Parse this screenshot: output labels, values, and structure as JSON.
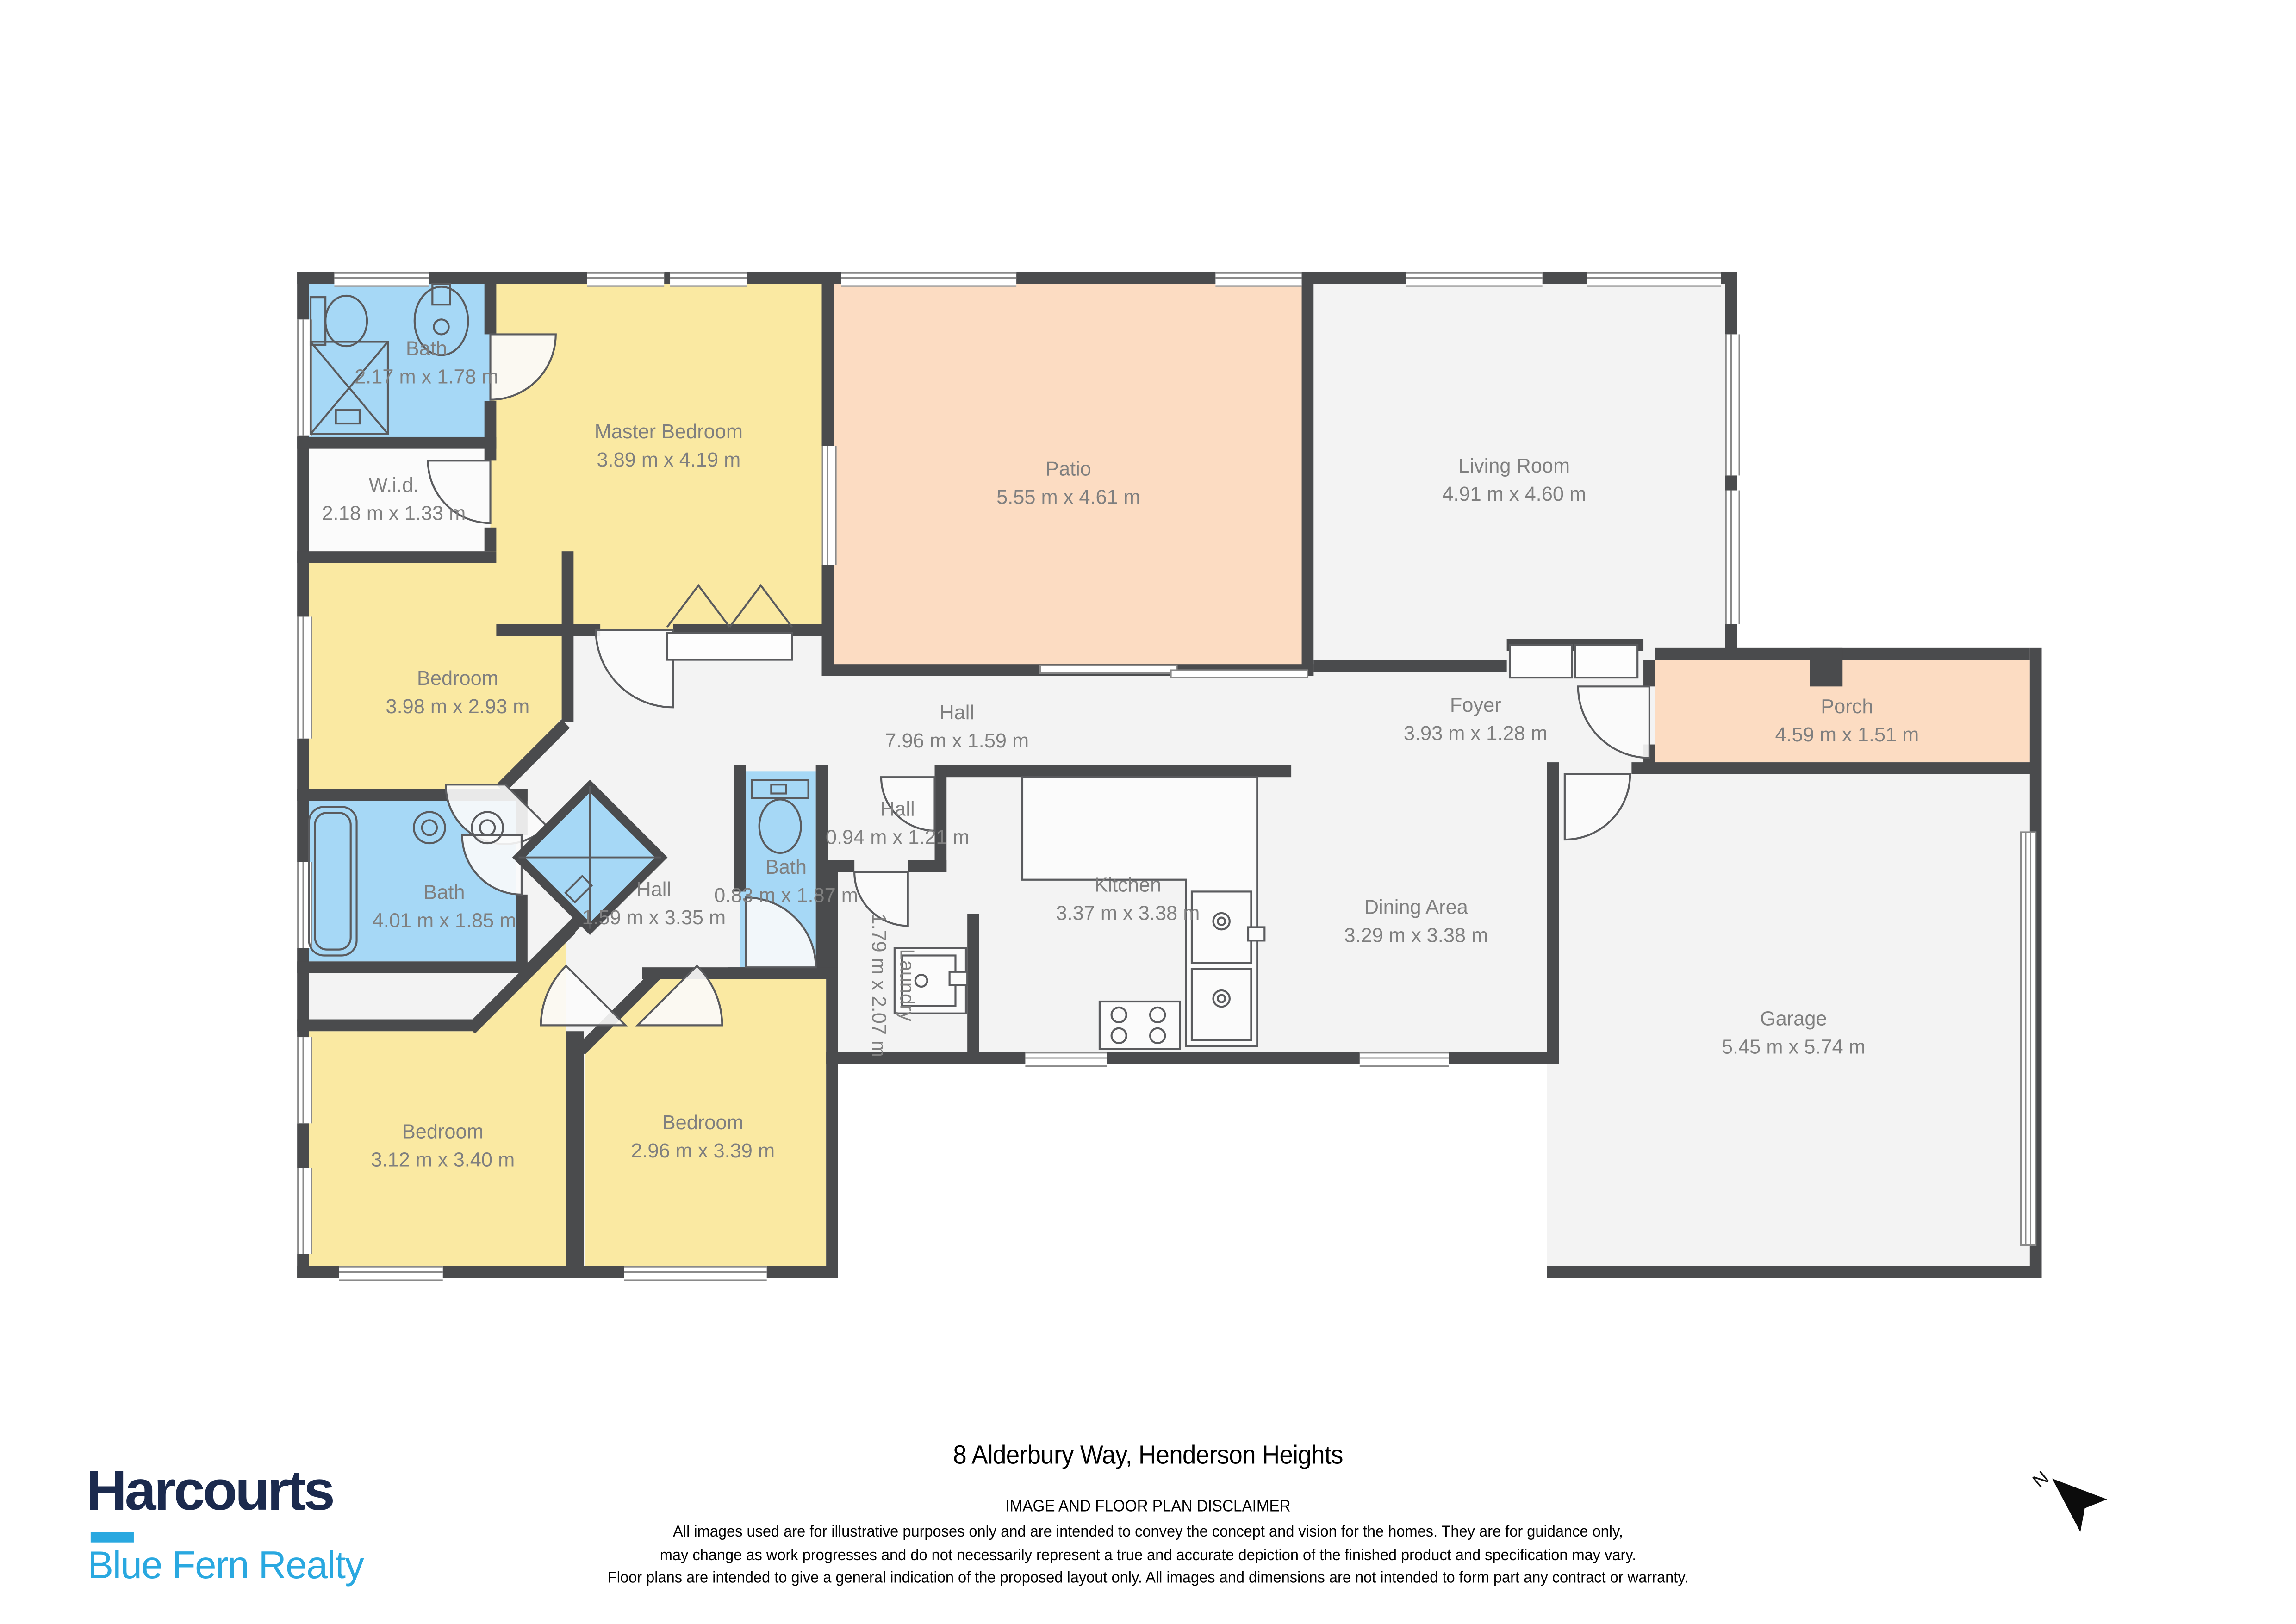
{
  "floorplan": {
    "rooms": [
      {
        "id": "bath-ensuite",
        "name": "Bath",
        "dims": "2.17 m x 1.78 m"
      },
      {
        "id": "wid",
        "name": "W.i.d.",
        "dims": "2.18 m x 1.33 m"
      },
      {
        "id": "master-bedroom",
        "name": "Master Bedroom",
        "dims": "3.89 m x 4.19 m"
      },
      {
        "id": "patio",
        "name": "Patio",
        "dims": "5.55 m x 4.61 m"
      },
      {
        "id": "living-room",
        "name": "Living Room",
        "dims": "4.91 m x 4.60 m"
      },
      {
        "id": "bedroom-mid-left",
        "name": "Bedroom",
        "dims": "3.98 m x 2.93 m"
      },
      {
        "id": "hall-main",
        "name": "Hall",
        "dims": "7.96 m x 1.59 m"
      },
      {
        "id": "foyer",
        "name": "Foyer",
        "dims": "3.93 m x 1.28 m"
      },
      {
        "id": "porch",
        "name": "Porch",
        "dims": "4.59 m x 1.51 m"
      },
      {
        "id": "bath-mid",
        "name": "Bath",
        "dims": "4.01 m x 1.85 m"
      },
      {
        "id": "hall-diagonal",
        "name": "Hall",
        "dims": "1.59 m x 3.35 m"
      },
      {
        "id": "bath-small",
        "name": "Bath",
        "dims": "0.83 m x 1.87 m"
      },
      {
        "id": "hall-small",
        "name": "Hall",
        "dims": "0.94 m x 1.21 m"
      },
      {
        "id": "laundry",
        "name": "Laundry",
        "dims": "1.79 m x 2.07 m"
      },
      {
        "id": "kitchen",
        "name": "Kitchen",
        "dims": "3.37 m x 3.38 m"
      },
      {
        "id": "dining-area",
        "name": "Dining Area",
        "dims": "3.29 m x 3.38 m"
      },
      {
        "id": "garage",
        "name": "Garage",
        "dims": "5.45 m x 5.74 m"
      },
      {
        "id": "bedroom-bottom-left",
        "name": "Bedroom",
        "dims": "3.12 m x 3.40 m"
      },
      {
        "id": "bedroom-bottom-mid",
        "name": "Bedroom",
        "dims": "2.96 m x 3.39 m"
      }
    ],
    "colors": {
      "wall": "#4a4b4d",
      "floor": "#f3f3f3",
      "bedroom_fill": "#fae9a2",
      "bath_fill": "#a6d8f6",
      "outdoor_fill": "#fcdcc2",
      "label_text": "#7f7f7f"
    }
  },
  "compass": {
    "label": "N"
  },
  "footer": {
    "address_title": "8 Alderbury Way, Henderson Heights",
    "disclaimer_title": "IMAGE AND FLOOR PLAN DISCLAIMER",
    "disclaimer_lines": [
      "All images used are for illustrative purposes only and are intended to convey the concept and vision for the homes. They are for guidance only,",
      "may change as work progresses and do not necessarily represent a true and accurate depiction of the finished product and specification may vary.",
      "Floor plans are intended to give a general indication of the proposed layout only. All images and dimensions are not intended to form part any contract or warranty."
    ]
  },
  "brand": {
    "name": "Harcourts",
    "tagline": "Blue Fern Realty",
    "navy": "#1b2a4e",
    "cyan": "#29a8e0"
  }
}
